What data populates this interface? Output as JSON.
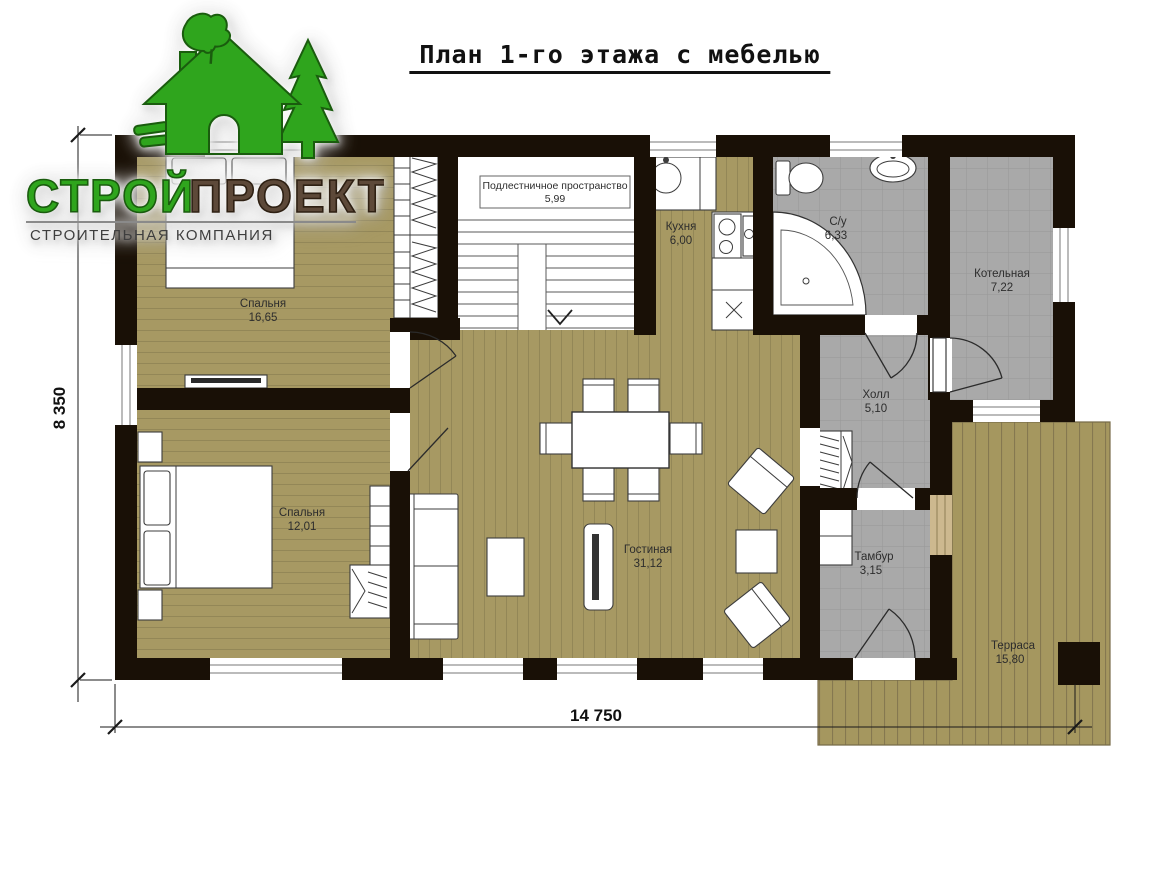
{
  "title": "План 1-го этажа с мебелью",
  "logo": {
    "name_part1": "СТРОЙ",
    "name_part2": "ПРОЕКТ",
    "subtitle": "СТРОИТЕЛЬНАЯ КОМПАНИЯ",
    "icon": "green-house-with-fir-tree-and-oak-leaf",
    "colors": {
      "green": "#2fa51d",
      "brown": "#5d4939",
      "subtitle_gray": "#3e3e3e"
    }
  },
  "plan": {
    "rooms": [
      {
        "id": "bedroom-1",
        "name": "Спальня",
        "area": "16,65"
      },
      {
        "id": "bedroom-2",
        "name": "Спальня",
        "area": "12,01"
      },
      {
        "id": "understairs",
        "name": "Подлестничное пространство",
        "area": "5,99"
      },
      {
        "id": "kitchen",
        "name": "Кухня",
        "area": "6,00"
      },
      {
        "id": "bathroom",
        "name": "С/у",
        "area": "6,33"
      },
      {
        "id": "boiler-room",
        "name": "Котельная",
        "area": "7,22"
      },
      {
        "id": "hall",
        "name": "Холл",
        "area": "5,10"
      },
      {
        "id": "living-room",
        "name": "Гостиная",
        "area": "31,12"
      },
      {
        "id": "vestibule",
        "name": "Тамбур",
        "area": "3,15"
      },
      {
        "id": "terrace",
        "name": "Терраса",
        "area": "15,80"
      }
    ],
    "dimensions": {
      "overall_width": "14 750",
      "overall_height": "8 350"
    },
    "colors": {
      "wall": "#191006",
      "wood_floor": "#a79963",
      "tile_floor": "#a9a9a9",
      "terrace_floor": "#a5975f",
      "window_sill_wood": "#cdb98f"
    }
  }
}
